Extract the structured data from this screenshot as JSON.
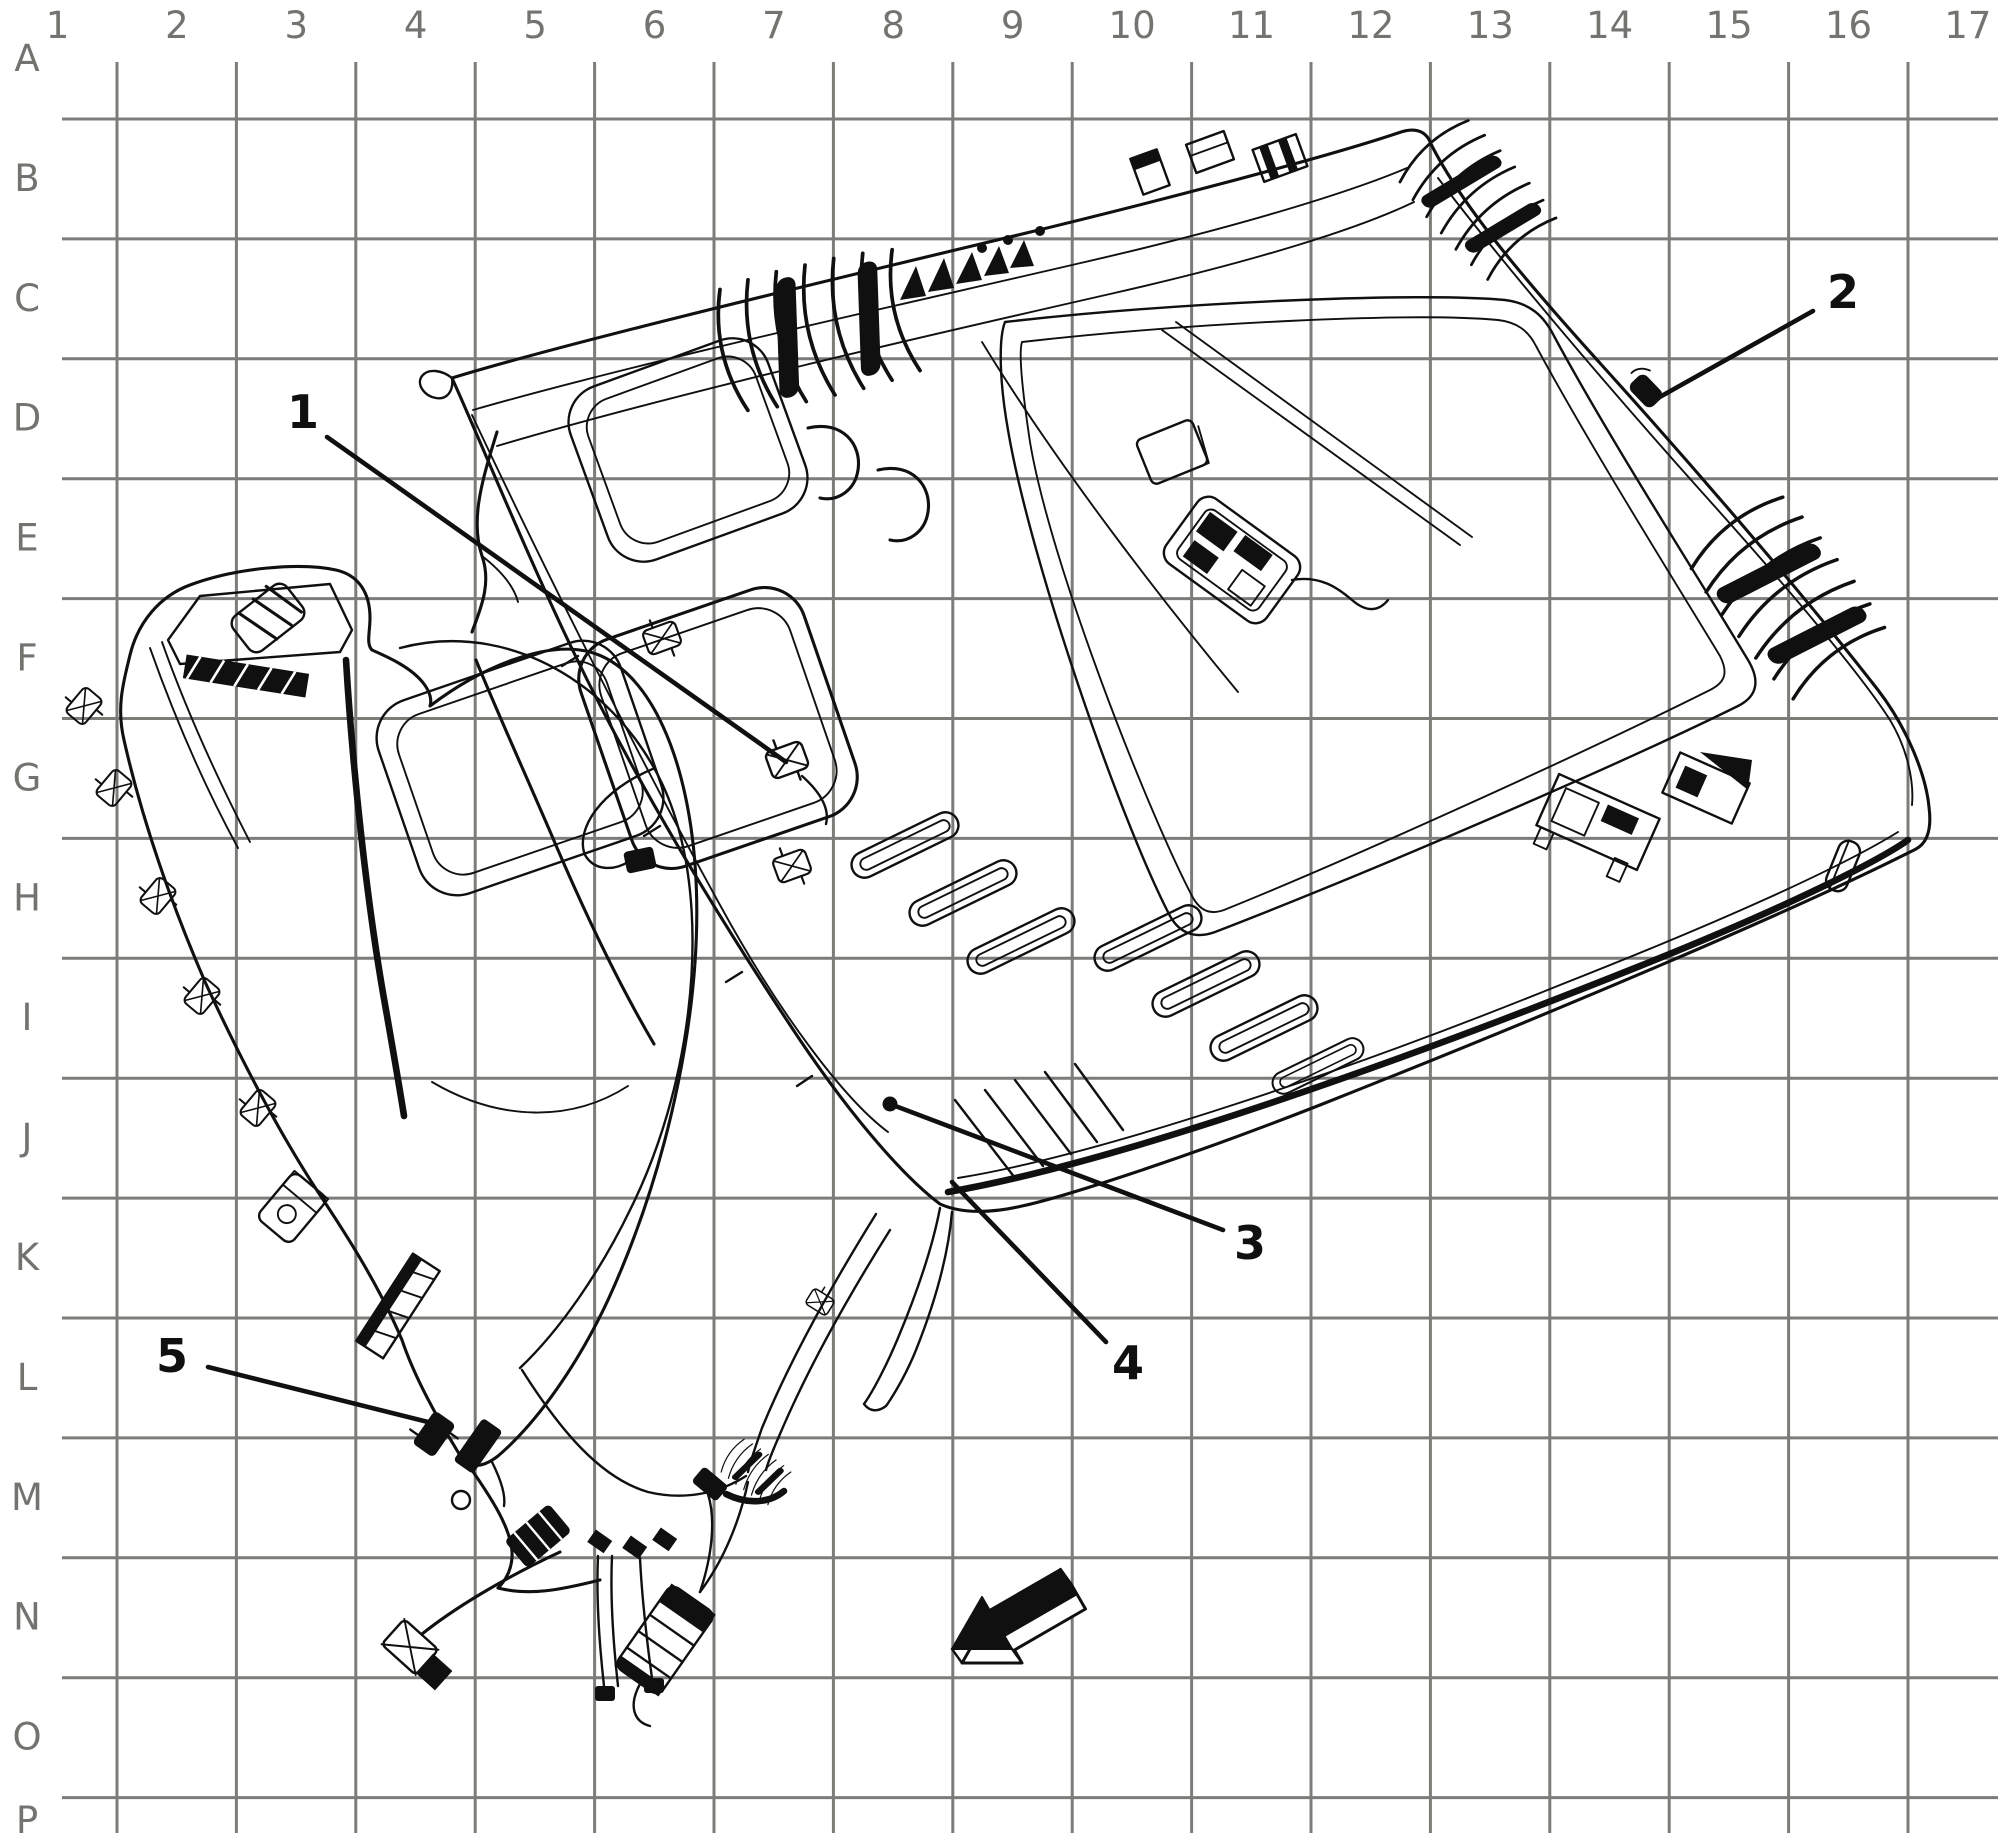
{
  "figure": {
    "type": "technical-line-illustration",
    "alt": "Service manual exploded view of vehicle headliner trim panel and instrument panel carrier over a lettered and numbered reference grid",
    "ink_color": "#101010",
    "paper_color": "#ffffff"
  },
  "grid": {
    "line_color": "#7c7c79",
    "label_color": "#73736f",
    "columns": [
      "1",
      "2",
      "3",
      "4",
      "5",
      "6",
      "7",
      "8",
      "9",
      "10",
      "11",
      "12",
      "13",
      "14",
      "15",
      "16",
      "17"
    ],
    "rows": [
      "A",
      "B",
      "C",
      "D",
      "E",
      "F",
      "G",
      "H",
      "I",
      "J",
      "K",
      "L",
      "M",
      "N",
      "O",
      "P"
    ]
  },
  "callouts": [
    {
      "number": "1"
    },
    {
      "number": "2"
    },
    {
      "number": "3"
    },
    {
      "number": "4"
    },
    {
      "number": "5"
    }
  ],
  "parts": {
    "assembly_1": "headliner-trim-panel",
    "assembly_2": "instrument-panel-carrier",
    "misc": [
      "sunroof-opening",
      "overhead-console-bracket",
      "sun-visor",
      "wiring-harness-connectors"
    ],
    "direction_arrow": "front-of-vehicle-arrow"
  }
}
